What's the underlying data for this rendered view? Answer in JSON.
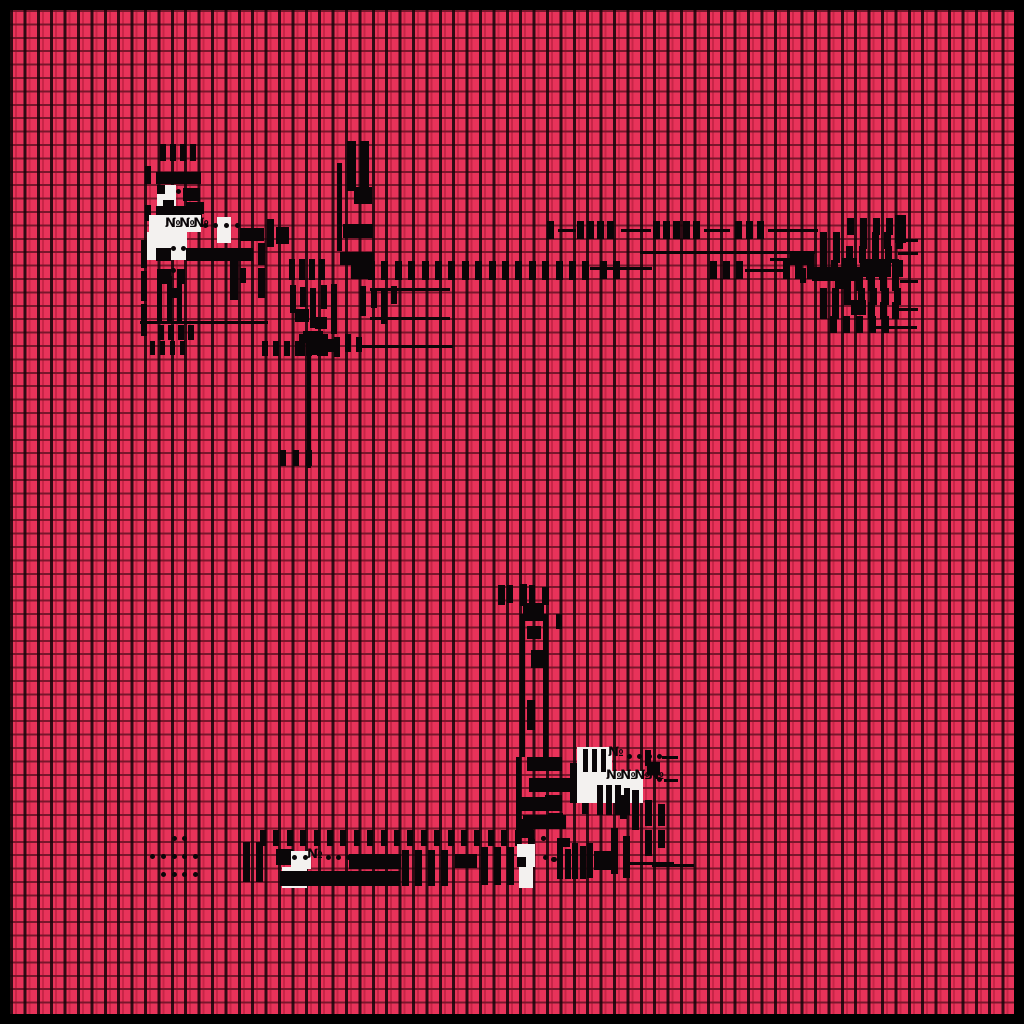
{
  "palette": {
    "background": "#e8335a",
    "ink": "#0a0608",
    "paper": "#f3f1ef",
    "frame": "#000000",
    "grid_line_vertical": "rgba(8,2,4,0.82)",
    "grid_line_horizontal": "rgba(25,2,8,0.55)"
  },
  "grid": {
    "cell": 13.4,
    "frame_border": 10,
    "cols": 75,
    "rows": 75
  },
  "labels": {
    "top_left": "№№№",
    "mid_right_small": "№",
    "mid_right_long": "№№№№",
    "bottom_arm": "№"
  },
  "glyphs": [
    {
      "t": "vbar",
      "x": 160,
      "y": 144,
      "n": 4,
      "dx": 10,
      "w": 6,
      "h": 17
    },
    {
      "t": "vbar",
      "x": 145,
      "y": 166,
      "w": 6,
      "h": 18
    },
    {
      "t": "hbar",
      "x": 156,
      "y": 172,
      "w": 45,
      "h": 12
    },
    {
      "t": "white",
      "x": 157,
      "y": 185,
      "w": 19,
      "h": 31
    },
    {
      "t": "block",
      "x": 157,
      "y": 185,
      "w": 8,
      "h": 9
    },
    {
      "t": "dot",
      "x": 176,
      "y": 189
    },
    {
      "t": "block",
      "x": 163,
      "y": 200,
      "w": 11,
      "h": 14
    },
    {
      "t": "block",
      "x": 183,
      "y": 188,
      "w": 17,
      "h": 13
    },
    {
      "t": "block",
      "x": 186,
      "y": 202,
      "w": 18,
      "h": 12
    },
    {
      "t": "vbar",
      "x": 145,
      "y": 205,
      "w": 6,
      "h": 16
    },
    {
      "t": "hbar",
      "x": 156,
      "y": 206,
      "w": 46,
      "h": 12
    },
    {
      "t": "white",
      "x": 149,
      "y": 215,
      "w": 52,
      "h": 17
    },
    {
      "t": "white",
      "x": 147,
      "y": 232,
      "w": 40,
      "h": 28
    },
    {
      "t": "white",
      "x": 217,
      "y": 217,
      "w": 14,
      "h": 26
    },
    {
      "t": "text",
      "x": 165,
      "y": 217,
      "s": "№№№"
    },
    {
      "t": "dot",
      "x": 203,
      "y": 223
    },
    {
      "t": "dot",
      "x": 213,
      "y": 223
    },
    {
      "t": "dot",
      "x": 224,
      "y": 223
    },
    {
      "t": "dot",
      "x": 235,
      "y": 223
    },
    {
      "t": "vbar",
      "x": 267,
      "y": 219,
      "w": 7,
      "h": 28
    },
    {
      "t": "hbar",
      "x": 240,
      "y": 228,
      "w": 24,
      "h": 13
    },
    {
      "t": "block",
      "x": 276,
      "y": 227,
      "w": 13,
      "h": 17
    },
    {
      "t": "dot",
      "x": 171,
      "y": 246
    },
    {
      "t": "dot",
      "x": 181,
      "y": 246
    },
    {
      "t": "block",
      "x": 156,
      "y": 248,
      "w": 15,
      "h": 13
    },
    {
      "t": "block",
      "x": 186,
      "y": 248,
      "w": 67,
      "h": 13
    },
    {
      "t": "dot",
      "x": 171,
      "y": 268
    },
    {
      "t": "block",
      "x": 157,
      "y": 269,
      "w": 14,
      "h": 15
    },
    {
      "t": "block",
      "x": 177,
      "y": 269,
      "w": 8,
      "h": 15
    },
    {
      "t": "vbar",
      "x": 230,
      "y": 261,
      "w": 8,
      "h": 39
    },
    {
      "t": "vbar",
      "x": 240,
      "y": 268,
      "w": 6,
      "h": 15
    },
    {
      "t": "vbar",
      "x": 258,
      "y": 243,
      "w": 7,
      "h": 22
    },
    {
      "t": "vbar",
      "x": 258,
      "y": 268,
      "w": 7,
      "h": 30
    },
    {
      "t": "vbar",
      "x": 141,
      "y": 240,
      "w": 6,
      "h": 28
    },
    {
      "t": "vbar",
      "x": 141,
      "y": 271,
      "w": 6,
      "h": 30
    },
    {
      "t": "vbar",
      "x": 141,
      "y": 304,
      "w": 6,
      "h": 32
    },
    {
      "t": "vbar",
      "x": 157,
      "y": 276,
      "w": 5,
      "h": 47
    },
    {
      "t": "vbar",
      "x": 167,
      "y": 276,
      "w": 5,
      "h": 47
    },
    {
      "t": "vbar",
      "x": 177,
      "y": 276,
      "w": 5,
      "h": 47
    },
    {
      "t": "block",
      "x": 169,
      "y": 288,
      "w": 12,
      "h": 10
    },
    {
      "t": "line",
      "x": 140,
      "y": 321,
      "w": 128
    },
    {
      "t": "vbar",
      "x": 158,
      "y": 325,
      "n": 4,
      "dx": 10,
      "w": 6,
      "h": 15
    },
    {
      "t": "vbar",
      "x": 150,
      "y": 341,
      "n": 4,
      "dx": 10,
      "w": 5,
      "h": 14
    },
    {
      "t": "vbar",
      "x": 347,
      "y": 141,
      "w": 9,
      "h": 50
    },
    {
      "t": "vbar",
      "x": 360,
      "y": 141,
      "w": 9,
      "h": 50
    },
    {
      "t": "vline",
      "x": 337,
      "y": 163,
      "w": 5,
      "h": 88
    },
    {
      "t": "block",
      "x": 354,
      "y": 187,
      "w": 18,
      "h": 17
    },
    {
      "t": "hbar",
      "x": 343,
      "y": 224,
      "w": 30,
      "h": 14
    },
    {
      "t": "hbar",
      "x": 340,
      "y": 252,
      "w": 34,
      "h": 13
    },
    {
      "t": "block",
      "x": 351,
      "y": 264,
      "w": 21,
      "h": 15
    },
    {
      "t": "vbar",
      "x": 289,
      "y": 259,
      "n": 4,
      "dx": 10,
      "w": 6,
      "h": 21
    },
    {
      "t": "vbar",
      "x": 290,
      "y": 285,
      "w": 6,
      "h": 28
    },
    {
      "t": "vbar",
      "x": 300,
      "y": 287,
      "w": 6,
      "h": 20
    },
    {
      "t": "vbar",
      "x": 310,
      "y": 288,
      "w": 6,
      "h": 40
    },
    {
      "t": "vbar",
      "x": 321,
      "y": 285,
      "w": 6,
      "h": 24
    },
    {
      "t": "vbar",
      "x": 331,
      "y": 284,
      "w": 6,
      "h": 50
    },
    {
      "t": "block",
      "x": 295,
      "y": 309,
      "w": 14,
      "h": 13
    },
    {
      "t": "block",
      "x": 315,
      "y": 317,
      "w": 12,
      "h": 12
    },
    {
      "t": "block",
      "x": 303,
      "y": 331,
      "w": 20,
      "h": 12
    },
    {
      "t": "block",
      "x": 324,
      "y": 339,
      "w": 13,
      "h": 13
    },
    {
      "t": "vbar",
      "x": 360,
      "y": 286,
      "w": 6,
      "h": 30
    },
    {
      "t": "vbar",
      "x": 371,
      "y": 288,
      "w": 6,
      "h": 20
    },
    {
      "t": "vbar",
      "x": 381,
      "y": 290,
      "w": 6,
      "h": 34
    },
    {
      "t": "vbar",
      "x": 391,
      "y": 286,
      "w": 6,
      "h": 18
    },
    {
      "t": "vbar",
      "x": 299,
      "y": 334,
      "w": 6,
      "h": 22
    },
    {
      "t": "vbar",
      "x": 311,
      "y": 337,
      "w": 6,
      "h": 18
    },
    {
      "t": "vbar",
      "x": 322,
      "y": 334,
      "w": 6,
      "h": 22
    },
    {
      "t": "vbar",
      "x": 334,
      "y": 337,
      "w": 6,
      "h": 20
    },
    {
      "t": "vbar",
      "x": 345,
      "y": 334,
      "w": 6,
      "h": 18
    },
    {
      "t": "vbar",
      "x": 356,
      "y": 337,
      "w": 6,
      "h": 15
    },
    {
      "t": "vbar",
      "x": 262,
      "y": 341,
      "n": 6,
      "dx": 11,
      "w": 6,
      "h": 15
    },
    {
      "t": "line",
      "x": 370,
      "y": 288,
      "w": 80
    },
    {
      "t": "line",
      "x": 370,
      "y": 317,
      "w": 80
    },
    {
      "t": "line",
      "x": 358,
      "y": 345,
      "w": 95
    },
    {
      "t": "vline",
      "x": 307,
      "y": 356,
      "w": 4,
      "h": 112
    },
    {
      "t": "vbar",
      "x": 280,
      "y": 450,
      "n": 3,
      "dx": 13,
      "w": 6,
      "h": 16
    },
    {
      "t": "vbar",
      "x": 547,
      "y": 221,
      "w": 7,
      "h": 18
    },
    {
      "t": "line",
      "x": 558,
      "y": 229,
      "w": 18
    },
    {
      "t": "vbar",
      "x": 577,
      "y": 221,
      "n": 4,
      "dx": 10,
      "w": 7,
      "h": 18
    },
    {
      "t": "line",
      "x": 621,
      "y": 229,
      "w": 30
    },
    {
      "t": "vbar",
      "x": 653,
      "y": 221,
      "n": 5,
      "dx": 10,
      "w": 7,
      "h": 18
    },
    {
      "t": "line",
      "x": 704,
      "y": 229,
      "w": 26
    },
    {
      "t": "vbar",
      "x": 735,
      "y": 221,
      "n": 3,
      "dx": 11,
      "w": 7,
      "h": 18
    },
    {
      "t": "line",
      "x": 768,
      "y": 229,
      "w": 50
    },
    {
      "t": "line",
      "x": 640,
      "y": 251,
      "w": 175
    },
    {
      "t": "vbar",
      "x": 368,
      "y": 261,
      "n": 17,
      "dx": 13.4,
      "w": 7,
      "h": 19
    },
    {
      "t": "line",
      "x": 590,
      "y": 267,
      "w": 62
    },
    {
      "t": "vbar",
      "x": 600,
      "y": 261,
      "n": 2,
      "dx": 13,
      "w": 7,
      "h": 18
    },
    {
      "t": "vbar",
      "x": 710,
      "y": 261,
      "n": 3,
      "dx": 13,
      "w": 7,
      "h": 18
    },
    {
      "t": "line",
      "x": 745,
      "y": 269,
      "w": 38
    },
    {
      "t": "vbar",
      "x": 783,
      "y": 261,
      "n": 3,
      "dx": 12,
      "w": 7,
      "h": 18
    },
    {
      "t": "block",
      "x": 812,
      "y": 267,
      "w": 48,
      "h": 14
    },
    {
      "t": "vbar",
      "x": 866,
      "y": 259,
      "n": 3,
      "dx": 13,
      "w": 7,
      "h": 21
    },
    {
      "t": "vbar",
      "x": 847,
      "y": 218,
      "n": 4,
      "dx": 13,
      "w": 7,
      "h": 17
    },
    {
      "t": "block",
      "x": 895,
      "y": 215,
      "w": 11,
      "h": 28
    },
    {
      "t": "vbar",
      "x": 820,
      "y": 232,
      "n": 2,
      "dx": 13,
      "w": 7,
      "h": 17
    },
    {
      "t": "vbar",
      "x": 860,
      "y": 232,
      "n": 4,
      "dx": 12,
      "w": 7,
      "h": 17
    },
    {
      "t": "line",
      "x": 900,
      "y": 239,
      "w": 18
    },
    {
      "t": "vbar",
      "x": 820,
      "y": 246,
      "n": 6,
      "dx": 13,
      "w": 7,
      "h": 17
    },
    {
      "t": "line",
      "x": 898,
      "y": 252,
      "w": 20
    },
    {
      "t": "block",
      "x": 842,
      "y": 258,
      "w": 15,
      "h": 15
    },
    {
      "t": "vbar",
      "x": 820,
      "y": 260,
      "n": 2,
      "dx": 11,
      "w": 7,
      "h": 17
    },
    {
      "t": "vbar",
      "x": 860,
      "y": 260,
      "n": 4,
      "dx": 12,
      "w": 7,
      "h": 17
    },
    {
      "t": "block",
      "x": 835,
      "y": 272,
      "w": 16,
      "h": 17
    },
    {
      "t": "vbar",
      "x": 856,
      "y": 274,
      "n": 4,
      "dx": 12,
      "w": 7,
      "h": 17
    },
    {
      "t": "line",
      "x": 900,
      "y": 280,
      "w": 18
    },
    {
      "t": "vbar",
      "x": 820,
      "y": 288,
      "n": 3,
      "dx": 12,
      "w": 7,
      "h": 17
    },
    {
      "t": "vbar",
      "x": 858,
      "y": 288,
      "n": 4,
      "dx": 12,
      "w": 7,
      "h": 17
    },
    {
      "t": "block",
      "x": 851,
      "y": 300,
      "w": 15,
      "h": 15
    },
    {
      "t": "vbar",
      "x": 820,
      "y": 302,
      "n": 2,
      "dx": 12,
      "w": 7,
      "h": 17
    },
    {
      "t": "vbar",
      "x": 868,
      "y": 302,
      "n": 3,
      "dx": 12,
      "w": 7,
      "h": 17
    },
    {
      "t": "line",
      "x": 898,
      "y": 308,
      "w": 20
    },
    {
      "t": "vbar",
      "x": 830,
      "y": 316,
      "n": 5,
      "dx": 13,
      "w": 7,
      "h": 17
    },
    {
      "t": "line",
      "x": 875,
      "y": 326,
      "w": 42
    },
    {
      "t": "hbar",
      "x": 790,
      "y": 252,
      "w": 24,
      "h": 13
    },
    {
      "t": "line",
      "x": 770,
      "y": 258,
      "w": 22
    },
    {
      "t": "vbar",
      "x": 800,
      "y": 268,
      "w": 6,
      "h": 15
    },
    {
      "t": "vbar",
      "x": 498,
      "y": 585,
      "w": 7,
      "h": 20
    },
    {
      "t": "vbar",
      "x": 507,
      "y": 585,
      "w": 6,
      "h": 18
    },
    {
      "t": "vbar",
      "x": 520,
      "y": 584,
      "w": 7,
      "h": 22
    },
    {
      "t": "vbar",
      "x": 529,
      "y": 585,
      "w": 6,
      "h": 18
    },
    {
      "t": "vbar",
      "x": 542,
      "y": 587,
      "w": 7,
      "h": 18
    },
    {
      "t": "block",
      "x": 523,
      "y": 603,
      "w": 21,
      "h": 18
    },
    {
      "t": "vline",
      "x": 520,
      "y": 614,
      "w": 5,
      "h": 143
    },
    {
      "t": "vline",
      "x": 543,
      "y": 614,
      "w": 5,
      "h": 143
    },
    {
      "t": "vbar",
      "x": 556,
      "y": 614,
      "w": 6,
      "h": 15
    },
    {
      "t": "block",
      "x": 527,
      "y": 626,
      "w": 14,
      "h": 13
    },
    {
      "t": "block",
      "x": 531,
      "y": 650,
      "w": 13,
      "h": 18
    },
    {
      "t": "vbar",
      "x": 527,
      "y": 700,
      "w": 8,
      "h": 30
    },
    {
      "t": "vline",
      "x": 516,
      "y": 757,
      "w": 5,
      "h": 76
    },
    {
      "t": "hbar",
      "x": 527,
      "y": 757,
      "w": 35,
      "h": 14
    },
    {
      "t": "hbar",
      "x": 529,
      "y": 778,
      "w": 41,
      "h": 14
    },
    {
      "t": "block",
      "x": 517,
      "y": 797,
      "w": 31,
      "h": 14
    },
    {
      "t": "hbar",
      "x": 523,
      "y": 815,
      "w": 43,
      "h": 14
    },
    {
      "t": "vbar",
      "x": 570,
      "y": 763,
      "w": 9,
      "h": 40
    },
    {
      "t": "vbar",
      "x": 582,
      "y": 788,
      "w": 6,
      "h": 26
    },
    {
      "t": "white",
      "x": 577,
      "y": 747,
      "w": 35,
      "h": 27
    },
    {
      "t": "white",
      "x": 577,
      "y": 771,
      "w": 66,
      "h": 32
    },
    {
      "t": "vbar",
      "x": 583,
      "y": 749,
      "w": 5,
      "h": 23
    },
    {
      "t": "vbar",
      "x": 592,
      "y": 749,
      "w": 5,
      "h": 23
    },
    {
      "t": "vbar",
      "x": 601,
      "y": 749,
      "w": 5,
      "h": 23
    },
    {
      "t": "text",
      "x": 608,
      "y": 746,
      "s": "№"
    },
    {
      "t": "dot",
      "x": 627,
      "y": 754,
      "n": 4,
      "dx": 10
    },
    {
      "t": "line",
      "x": 662,
      "y": 756,
      "w": 16
    },
    {
      "t": "text",
      "x": 606,
      "y": 769,
      "s": "№№№№"
    },
    {
      "t": "dot",
      "x": 657,
      "y": 777
    },
    {
      "t": "line",
      "x": 664,
      "y": 779,
      "w": 14
    },
    {
      "t": "vbar",
      "x": 597,
      "y": 785,
      "w": 6,
      "h": 30
    },
    {
      "t": "vbar",
      "x": 606,
      "y": 785,
      "w": 6,
      "h": 30
    },
    {
      "t": "vbar",
      "x": 615,
      "y": 785,
      "w": 6,
      "h": 30
    },
    {
      "t": "vbar",
      "x": 624,
      "y": 788,
      "w": 6,
      "h": 27
    },
    {
      "t": "vbar",
      "x": 645,
      "y": 750,
      "w": 6,
      "h": 16
    },
    {
      "t": "block",
      "x": 647,
      "y": 762,
      "w": 13,
      "h": 13
    },
    {
      "t": "vbar",
      "x": 632,
      "y": 790,
      "w": 7,
      "h": 40
    },
    {
      "t": "vbar",
      "x": 620,
      "y": 795,
      "w": 7,
      "h": 24
    },
    {
      "t": "vbar",
      "x": 645,
      "y": 800,
      "w": 7,
      "h": 26
    },
    {
      "t": "vbar",
      "x": 658,
      "y": 804,
      "w": 7,
      "h": 22
    },
    {
      "t": "vbar",
      "x": 645,
      "y": 830,
      "w": 7,
      "h": 26
    },
    {
      "t": "vbar",
      "x": 658,
      "y": 830,
      "w": 7,
      "h": 18
    },
    {
      "t": "line",
      "x": 652,
      "y": 864,
      "w": 42
    },
    {
      "t": "block",
      "x": 545,
      "y": 795,
      "w": 17,
      "h": 16
    },
    {
      "t": "block",
      "x": 548,
      "y": 813,
      "w": 15,
      "h": 15
    },
    {
      "t": "dot",
      "x": 541,
      "y": 836
    },
    {
      "t": "dot",
      "x": 543,
      "y": 855
    },
    {
      "t": "dot",
      "x": 551,
      "y": 857
    },
    {
      "t": "block",
      "x": 557,
      "y": 838,
      "w": 13,
      "h": 9
    },
    {
      "t": "vbar",
      "x": 557,
      "y": 847,
      "w": 6,
      "h": 32
    },
    {
      "t": "vbar",
      "x": 565,
      "y": 849,
      "w": 6,
      "h": 30
    },
    {
      "t": "vbar",
      "x": 572,
      "y": 843,
      "w": 6,
      "h": 36
    },
    {
      "t": "vbar",
      "x": 580,
      "y": 846,
      "w": 6,
      "h": 33
    },
    {
      "t": "vbar",
      "x": 587,
      "y": 843,
      "w": 6,
      "h": 35
    },
    {
      "t": "block",
      "x": 594,
      "y": 851,
      "w": 17,
      "h": 19
    },
    {
      "t": "vbar",
      "x": 611,
      "y": 828,
      "w": 7,
      "h": 46
    },
    {
      "t": "vbar",
      "x": 623,
      "y": 836,
      "w": 7,
      "h": 42
    },
    {
      "t": "line",
      "x": 630,
      "y": 862,
      "w": 44
    },
    {
      "t": "vbar",
      "x": 260,
      "y": 830,
      "n": 21,
      "dx": 13.4,
      "w": 6,
      "h": 16
    },
    {
      "t": "block",
      "x": 516,
      "y": 819,
      "w": 17,
      "h": 19
    },
    {
      "t": "vbar",
      "x": 243,
      "y": 842,
      "w": 7,
      "h": 40
    },
    {
      "t": "vbar",
      "x": 256,
      "y": 842,
      "w": 7,
      "h": 40
    },
    {
      "t": "block",
      "x": 276,
      "y": 849,
      "w": 17,
      "h": 16
    },
    {
      "t": "white",
      "x": 291,
      "y": 851,
      "w": 20,
      "h": 18
    },
    {
      "t": "white",
      "x": 282,
      "y": 867,
      "w": 25,
      "h": 21
    },
    {
      "t": "dot",
      "x": 292,
      "y": 855
    },
    {
      "t": "dot",
      "x": 303,
      "y": 855
    },
    {
      "t": "text",
      "x": 307,
      "y": 848,
      "s": "№"
    },
    {
      "t": "dot",
      "x": 326,
      "y": 855
    },
    {
      "t": "dot",
      "x": 336,
      "y": 855
    },
    {
      "t": "dot",
      "x": 346,
      "y": 855
    },
    {
      "t": "hbar",
      "x": 349,
      "y": 854,
      "w": 52,
      "h": 15
    },
    {
      "t": "vbar",
      "x": 402,
      "y": 850,
      "n": 4,
      "dx": 13,
      "w": 7,
      "h": 36
    },
    {
      "t": "block",
      "x": 455,
      "y": 854,
      "w": 22,
      "h": 14
    },
    {
      "t": "vbar",
      "x": 481,
      "y": 847,
      "n": 3,
      "dx": 13,
      "w": 7,
      "h": 38
    },
    {
      "t": "block",
      "x": 280,
      "y": 871,
      "w": 120,
      "h": 15
    },
    {
      "t": "white",
      "x": 517,
      "y": 844,
      "w": 18,
      "h": 23
    },
    {
      "t": "white",
      "x": 519,
      "y": 866,
      "w": 14,
      "h": 22
    },
    {
      "t": "block",
      "x": 517,
      "y": 857,
      "w": 9,
      "h": 10
    },
    {
      "t": "dot",
      "x": 530,
      "y": 838
    },
    {
      "t": "dot",
      "x": 541,
      "y": 836
    },
    {
      "t": "dot",
      "x": 552,
      "y": 857
    },
    {
      "t": "dot",
      "x": 172,
      "y": 836
    },
    {
      "t": "dot",
      "x": 182,
      "y": 836
    },
    {
      "t": "dot",
      "x": 150,
      "y": 854
    },
    {
      "t": "dot",
      "x": 161,
      "y": 854
    },
    {
      "t": "dot",
      "x": 172,
      "y": 854
    },
    {
      "t": "dot",
      "x": 182,
      "y": 854
    },
    {
      "t": "dot",
      "x": 193,
      "y": 854
    },
    {
      "t": "dot",
      "x": 161,
      "y": 872
    },
    {
      "t": "dot",
      "x": 172,
      "y": 872
    },
    {
      "t": "dot",
      "x": 182,
      "y": 872
    },
    {
      "t": "dot",
      "x": 193,
      "y": 872
    }
  ]
}
